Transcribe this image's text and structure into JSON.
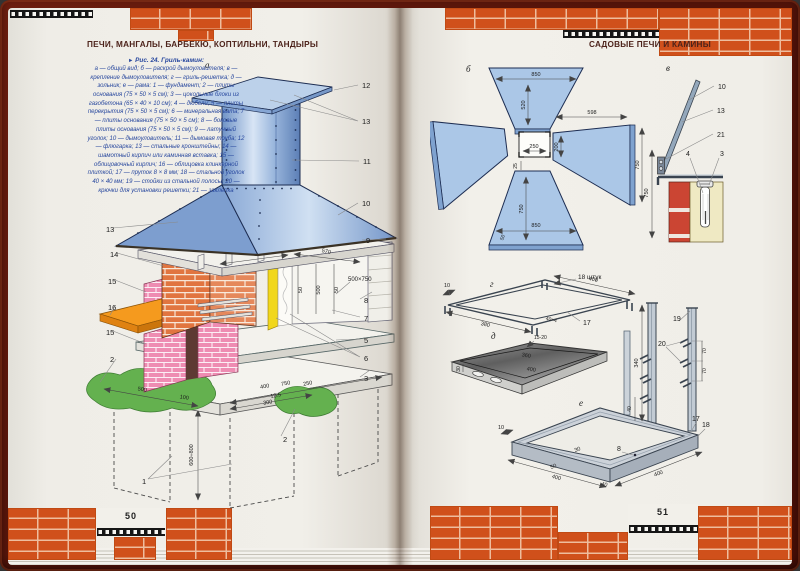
{
  "book": {
    "left_page": {
      "header": "ПЕЧИ, МАНГАЛЫ, БАРБЕКЮ, КОПТИЛЬНИ, ТАНДЫРЫ",
      "page_number": "50",
      "figure": {
        "marker": "►",
        "caption": "Рис. 24. Гриль-камин:",
        "legend": "а — общий вид; б — раскрой дымоуловителя; в — крепление дымоуловителя; г — гриль-решетка; д — зольник; е — рама: 1 — фундамент; 2 — плиты основания (75 × 50 × 5 см); 3 — цокольные блоки из газобетона (65 × 40 × 10 см); 4 — дюбели; 5 — плиты перекрытия (75 × 50 × 5 см); 6 — минеральная вата; 7 — плиты основания (75 × 50 × 5 см); 8 — боковые плиты основания (75 × 50 × 5 см); 9 — латунный уголок; 10 — дымоуловитель; 11 — дымовая труба; 12 — флюгарка; 13 — стальные кронштейны; 14 — шамотный кирпич или каминная вставка; 15 — облицовочный кирпич; 16 — облицовка клинкерной плиткой; 17 — пруток 8 × 8 мм; 18 — стальной уголок 40 × 40 мм; 19 — стойки из стальной полосы; 20 — крючки для установки решетки; 21 — заклепка"
      },
      "diagram_a": {
        "label": "а",
        "callouts": {
          "c1": "1",
          "c2l": "2",
          "c2r": "2",
          "c3": "3",
          "c5": "5",
          "c6": "6",
          "c7": "7",
          "c8": "8",
          "c9": "9",
          "c10": "10",
          "c11": "11",
          "c12": "12",
          "c13l": "13",
          "c13r": "13",
          "c14": "14",
          "c15a": "15",
          "c15b": "15",
          "c16": "16"
        },
        "dims": {
          "hood_400": "400",
          "hood_570": "570",
          "niche_50a": "50",
          "niche_500": "500",
          "niche_50b": "50",
          "note": "500×750",
          "front_500": "500",
          "front_100": "100",
          "front_300": "300",
          "right_400": "400",
          "right_750": "750",
          "right_125": "12.5",
          "right_250": "250",
          "depth": "600÷800"
        }
      }
    },
    "right_page": {
      "header": "САДОВЫЕ ПЕЧИ И КАМИНЫ",
      "page_number": "51",
      "diagram_b": {
        "label": "б",
        "dims": {
          "top_850": "850",
          "top_520": "520",
          "center_250": "250",
          "right_598": "598",
          "right_200": "200",
          "right_750": "750",
          "gap_25": "25",
          "bot_750": "750",
          "bot_850": "850",
          "bot_50": "50"
        }
      },
      "diagram_v": {
        "label": "в",
        "callouts": {
          "c10": "10",
          "c13": "13",
          "c21": "21",
          "c4": "4",
          "c3": "3"
        },
        "dims": {
          "h750": "750"
        }
      },
      "diagram_g": {
        "label": "г",
        "note": "18 штук",
        "callouts": {
          "c17": "17"
        },
        "dims": {
          "d10": "10",
          "d400": "400",
          "d380": "380",
          "d40x4": "40×4"
        }
      },
      "diagram_d": {
        "label": "д",
        "dims": {
          "lip": "15-20",
          "d30": "30",
          "d360": "360",
          "d400": "400"
        }
      },
      "diagram_e": {
        "label": "е",
        "callouts": {
          "c19": "19",
          "c20": "20",
          "c17": "17",
          "c18": "18",
          "c8": "8"
        },
        "dims": {
          "h340": "340",
          "s70a": "70",
          "s70b": "70",
          "d40": "40",
          "d10": "10",
          "d30": "30",
          "d50": "50",
          "l400": "400",
          "m40": "40",
          "r400": "400"
        }
      }
    }
  }
}
